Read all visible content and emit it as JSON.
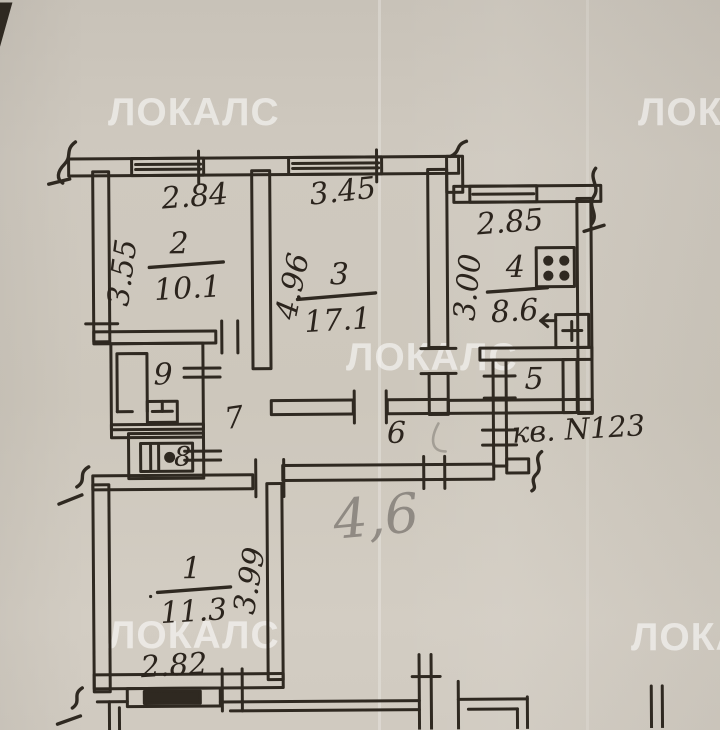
{
  "watermark": {
    "text": "ЛОКАЛС"
  },
  "plan": {
    "apartment_note": "кв. N123",
    "pencil_note": "4,6",
    "rooms": {
      "room1": {
        "number": "1",
        "area": "11.3",
        "dim_bottom": "2.82",
        "dim_side": "3.99"
      },
      "room2": {
        "number": "2",
        "area": "10.1",
        "dim_top": "2.84",
        "dim_side": "3.55"
      },
      "room3": {
        "number": "3",
        "area": "17.1",
        "dim_top": "3.45",
        "dim_side": "4.96"
      },
      "room4": {
        "number": "4",
        "area": "8.6",
        "dim_top": "2.85",
        "dim_side": "3.00"
      },
      "room5": {
        "number": "5"
      },
      "room6": {
        "number": "6"
      },
      "room7": {
        "number": "7"
      },
      "room8": {
        "number": "8"
      },
      "room9": {
        "number": "9"
      }
    }
  }
}
